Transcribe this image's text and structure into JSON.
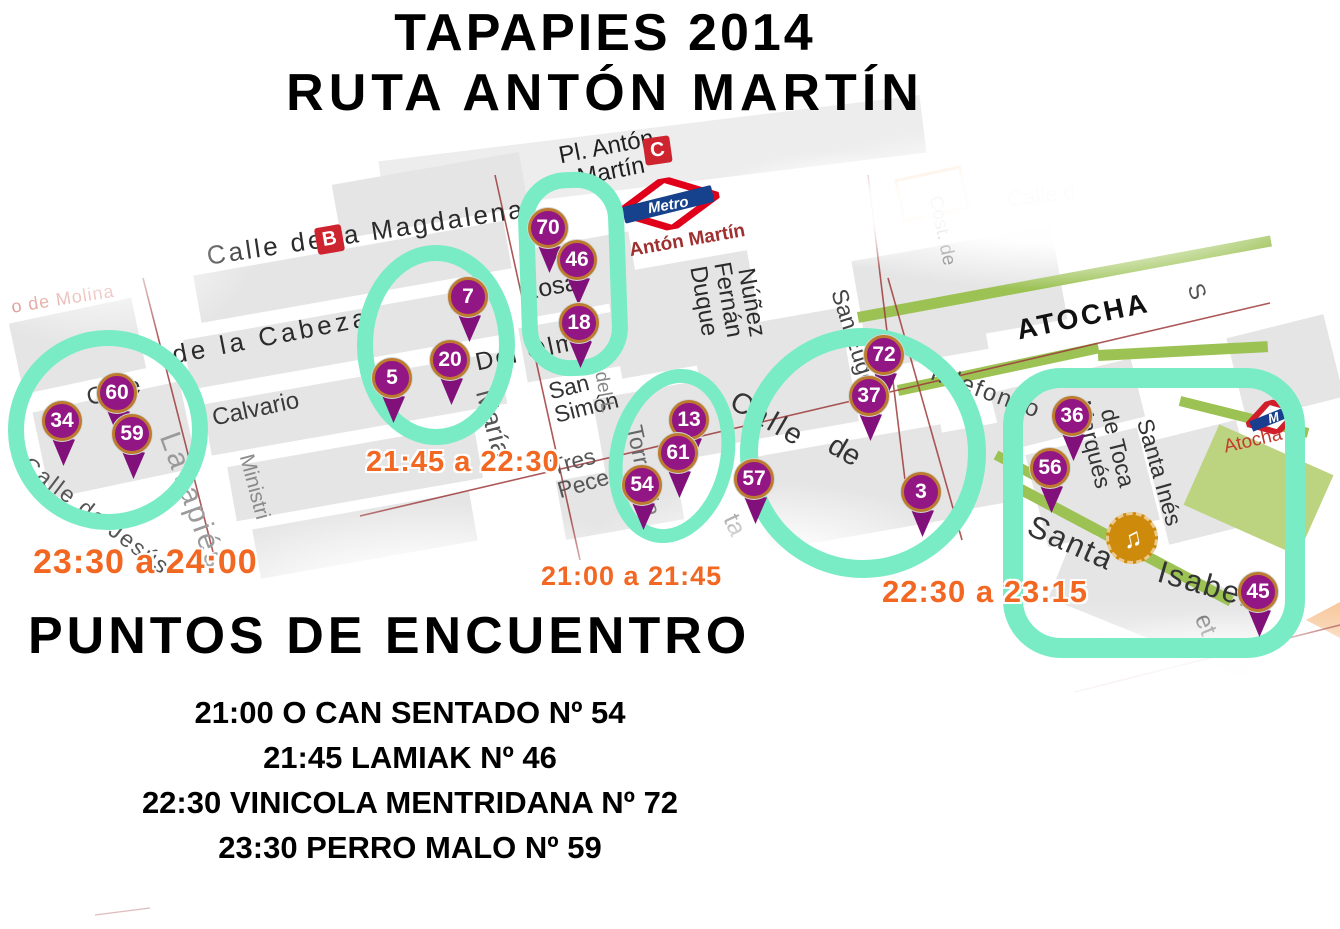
{
  "title": {
    "line1": "TAPAPIES 2014",
    "line2": "RUTA ANTÓN MARTÍN"
  },
  "colors": {
    "highlight_teal": "#79ECC5",
    "pin_purple": "#931685",
    "time_orange": "#F26722",
    "metro_red": "#E0001A",
    "metro_blue": "#16418C",
    "street_green_edge": "#9CC254"
  },
  "map": {
    "badges": {
      "bus": "B",
      "cercanias": "C"
    },
    "metro_logo": {
      "brand": "Metro",
      "station": "Antón Martín"
    },
    "atocha_metro": {
      "m": "M"
    },
    "poi_music_glyph": "♫",
    "streets": [
      "Pl. Antón\nMartín",
      "Calle de la Magdalena",
      "de la Cabeza",
      "o de Molina",
      "Calle",
      "Calle de Jesús",
      "Lavapiés",
      "Calvario",
      "Ministri",
      "Rosa",
      "Del Olmo",
      "María",
      "San\nSimón",
      "Tres\nPeces",
      "Torrecilla",
      "del L",
      "Duque",
      "Fernán",
      "Núñez",
      "San Eugenio",
      "Calle",
      "de",
      "Santa",
      "Isabel",
      "ATOCHA",
      "Cost. de",
      "Calle d",
      "Ildefonso",
      "Marqués",
      "de Toca",
      "Santa Inés",
      "Atocha",
      "et",
      "ta",
      "S"
    ],
    "pins": [
      70,
      46,
      18,
      7,
      20,
      5,
      60,
      34,
      59,
      13,
      61,
      54,
      57,
      72,
      37,
      3,
      36,
      56,
      45
    ]
  },
  "time_labels": [
    "23:30 a 24:00",
    "21:45 a 22:30",
    "21:00 a 21:45",
    "22:30 a 23:15"
  ],
  "meeting": {
    "heading": "PUNTOS DE ENCUENTRO",
    "items": [
      "21:00 O CAN SENTADO Nº 54",
      "21:45 LAMIAK Nº 46",
      "22:30 VINICOLA MENTRIDANA Nº 72",
      "23:30 PERRO MALO Nº 59"
    ]
  }
}
